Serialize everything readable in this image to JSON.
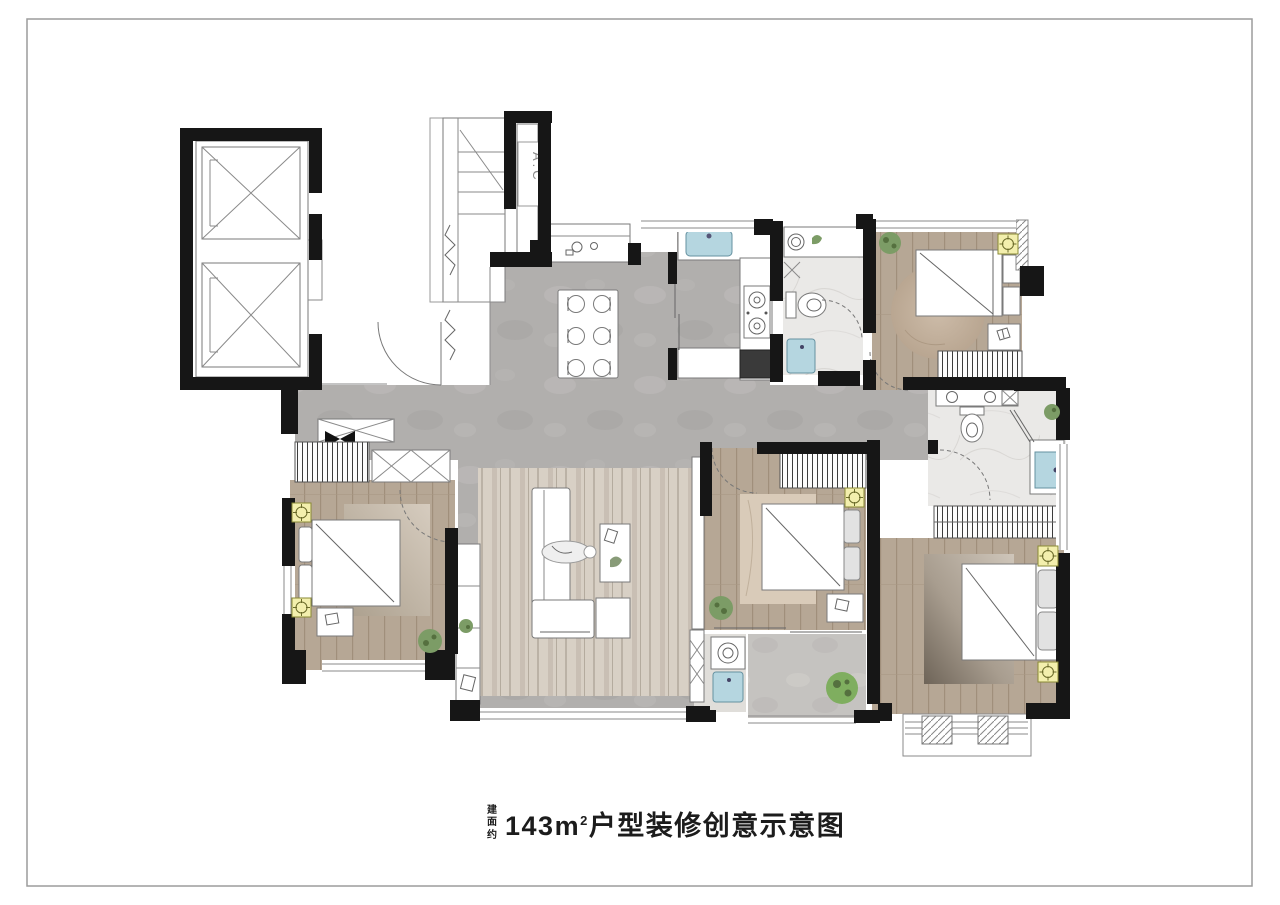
{
  "caption": {
    "prefix_stacked": "建面约",
    "area_number": "143",
    "area_unit": "m",
    "area_superscript": "2",
    "suffix": "户型装修创意示意图"
  },
  "floor_plan": {
    "ac_label": "A.C",
    "rooms": [
      "elevator-hall",
      "entry-foyer",
      "entry-closet",
      "dining-room",
      "kitchen",
      "bathroom-main",
      "bedroom-top-right",
      "master-bathroom",
      "walk-in-wardrobe",
      "master-bedroom",
      "living-room",
      "bedroom-left",
      "bedroom-middle",
      "laundry-room",
      "service-balcony",
      "master-balcony"
    ],
    "palette": {
      "wall": "#161616",
      "tile_floor": "#b1afad",
      "wood_floor": "#b6a795",
      "marble_floor": "#eae9e7",
      "living_rug": "#d8d0c5",
      "fixture_blue": "#b5d6e0",
      "lamp_yellow": "#f3efad",
      "plant_green": "#7c9c66",
      "frame_border": "#9c9c9c",
      "caption_text": "#1c1c1c"
    }
  }
}
